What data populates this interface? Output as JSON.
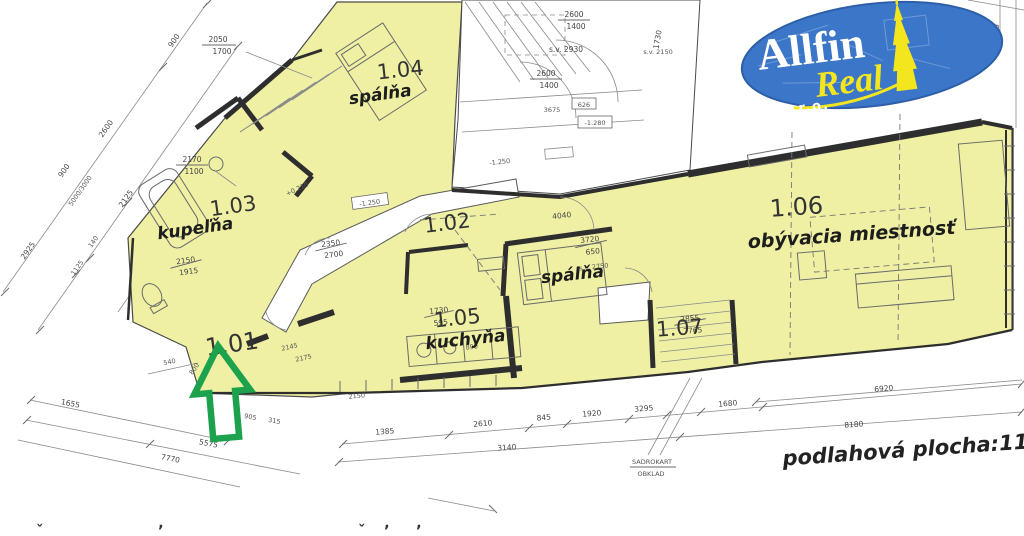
{
  "plan": {
    "rooms": [
      {
        "number": "1.01",
        "name": ""
      },
      {
        "number": "1.02",
        "name": "spálňa"
      },
      {
        "number": "1.03",
        "name": "kupeľňa"
      },
      {
        "number": "1.04",
        "name": "spálňa"
      },
      {
        "number": "1.05",
        "name": "kuchyňa"
      },
      {
        "number": "1.06",
        "name": "obývacia miestnosť"
      },
      {
        "number": "1.07",
        "name": ""
      }
    ],
    "floor_area_note": "podlahová plocha:114 m2",
    "material_note": {
      "line1": "SADROKART",
      "line2": "OBKLAD"
    }
  },
  "logo": {
    "name": "Allfin",
    "sub": "Real",
    "suffix": "s.r.o."
  },
  "colors": {
    "highlight": "#eff0a3",
    "logo_blue": "#3b76c8",
    "logo_yellow": "#f3e51e",
    "arrow_green": "#1ca24d"
  },
  "icons": {
    "entrance_arrow": "arrow-up",
    "logo_tower": "cathedral-spire"
  },
  "dimensions": {
    "top_left": {
      "a": "2050",
      "b": "1700",
      "c": "900",
      "d": "2600",
      "e": "2925",
      "f": "2125",
      "g": "140",
      "h": "1125",
      "i": "900",
      "j": "5000/3000",
      "k": "2170",
      "l": "1100",
      "m": "2150",
      "n": "1915"
    },
    "top_mid": {
      "a": "2600",
      "b": "1400",
      "c": "s.v. 2930",
      "d": "2600",
      "e": "1400",
      "f": "3675",
      "g": "626",
      "h": "-1.280",
      "i": "1730",
      "j": "s.v. 2150",
      "k": "2560"
    },
    "interior": {
      "a": "+0.210",
      "b": "2350",
      "c": "2700",
      "d": "-1.250",
      "e": "-1.250",
      "f": "4040",
      "g": "3720",
      "h": "650",
      "i": "s.v. 2750",
      "j": "1730",
      "k": "595",
      "l": "890",
      "m": "2855",
      "n": "7765",
      "o": "2150",
      "p": "800",
      "q": "2145",
      "r": "2175",
      "s": "905",
      "t": "315",
      "u": "540"
    },
    "chain_top": [
      "1385",
      "2610",
      "845",
      "1920",
      "3295",
      "1680",
      "6920"
    ],
    "chain_bottom": [
      "3140",
      "8180"
    ],
    "left_bottom": [
      "1655",
      "5575",
      "7770"
    ]
  },
  "cutoff_glyphs": [
    "ˇ",
    "ʼ",
    "ˇ",
    "ʼ",
    "ʼ"
  ]
}
